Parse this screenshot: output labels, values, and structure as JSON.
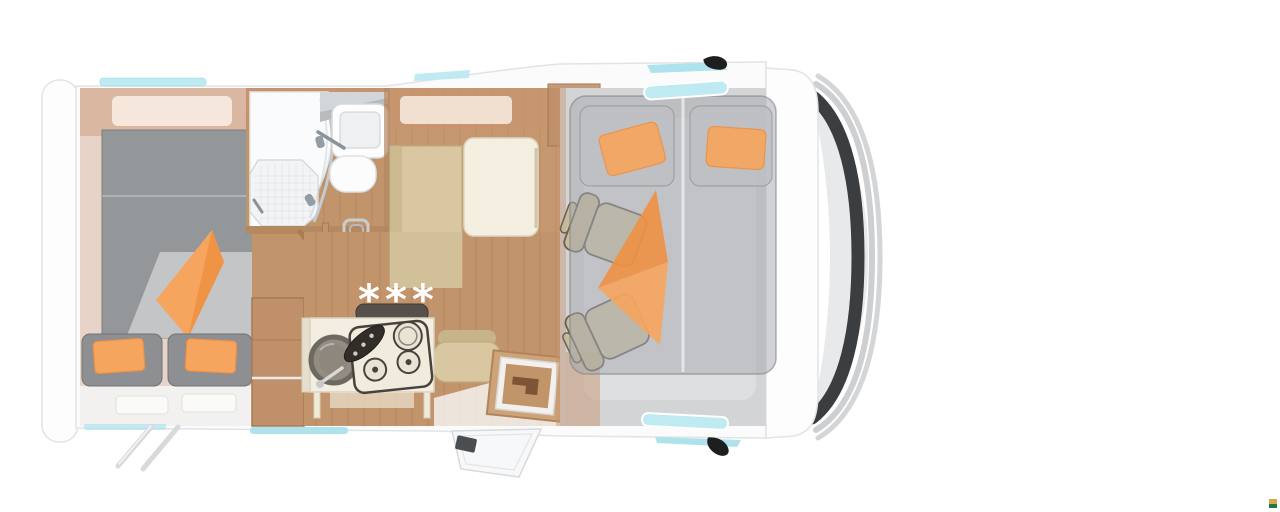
{
  "scene": {
    "title": "Motorhome floor plan top view",
    "floor": {
      "marking": "***"
    }
  },
  "colors": {
    "white": "#ffffff",
    "bodyWhite": "#fbfbfc",
    "bodyOutline": "#e2e3e5",
    "rearCap": "#fdfdfe",
    "hoodGray": "#e8e9ea",
    "windshieldDark": "#3b3e41",
    "bumperSilver": "#d4d5d7",
    "paintArc": "#cdcfd1",
    "windowCyan": "#bfeaf2",
    "windowCyanDeep": "#aee3ed",
    "wallWood": "#c89470",
    "woodSolid": "#bf9069",
    "woodDark": "#a87a52",
    "floorWood": "#c2946c",
    "floorSeam": "#7a4e30",
    "mattressGray": "#94979a",
    "cushionGray": "#8d8f92",
    "duvetLight": "#c3c5c7",
    "orange": "#f6a55e",
    "orangeDeep": "#ee9143",
    "benchBeige": "#d8c7a1",
    "benchEdge": "#c0ac82",
    "tableCream": "#f4efe1",
    "creamEdge": "#ddd6c2",
    "counterCream": "#f3eee1",
    "stoveDark": "#46433c",
    "knobBlack": "#312e29",
    "lidDark": "#55514a",
    "sinkRim": "#6e6960",
    "sinkBowl": "#928c82",
    "showerWhite": "#fafbfc",
    "grayFixture": "#b7bbbe",
    "chrome": "#8b9298",
    "cabFloor": "#d2d4d6",
    "cabFloorLight": "#dcdee0",
    "seatBeige": "#d0c4a2",
    "seatOutline": "#5a564d",
    "pillowGray": "#bec0c3",
    "mirrorBlack": "#1d1e20",
    "legGray": "#d8d9db",
    "badgeTop": "#d5a74f",
    "badgeBottom": "#1e7a45"
  }
}
